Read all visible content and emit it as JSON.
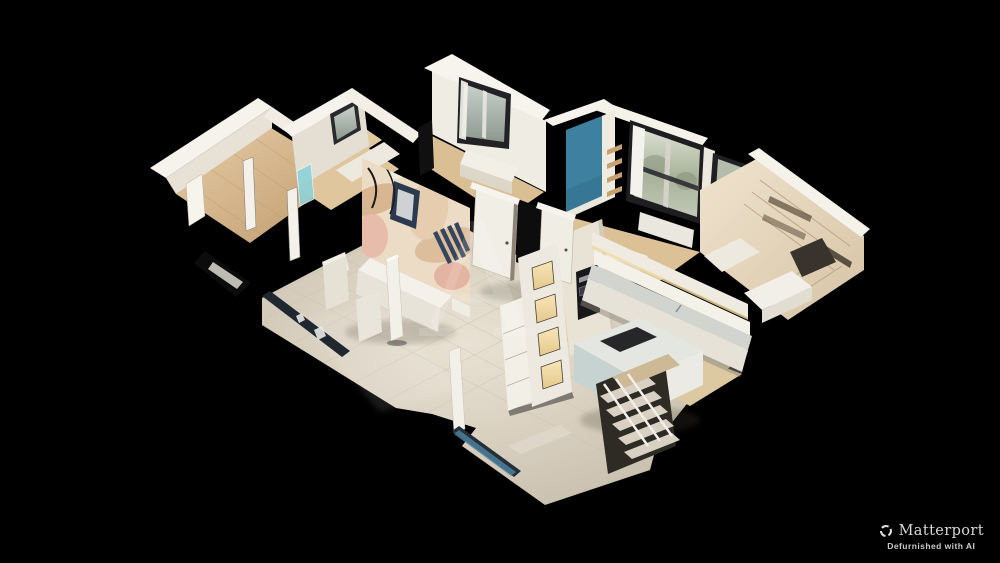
{
  "viewer": {
    "type": "matterport-dollhouse-3d-view",
    "background": "#000000",
    "watermark_letter": "A"
  },
  "branding": {
    "logo": "Matterport",
    "tagline": "Defurnished with AI",
    "logo_icon": "matterport-shutter-icon",
    "text_color": "#d8d8d8"
  },
  "palette": {
    "wall_bright": "#f6f3ec",
    "wall": "#efebe2",
    "wall_shade": "#d9d2c5",
    "floor_tile": "#d8cec0",
    "floor_wood": "#d6b98f",
    "accent_blue": "#3e80a0",
    "window_frame": "#1f1f22",
    "window_view": "#aab3a6",
    "mural_pink": "#e8bcab",
    "mural_navy": "#2c3a50",
    "counter_gray": "#d2d5cf",
    "glass_teal": "#4f84a0",
    "cubby_warm": "#f0d9a4"
  }
}
